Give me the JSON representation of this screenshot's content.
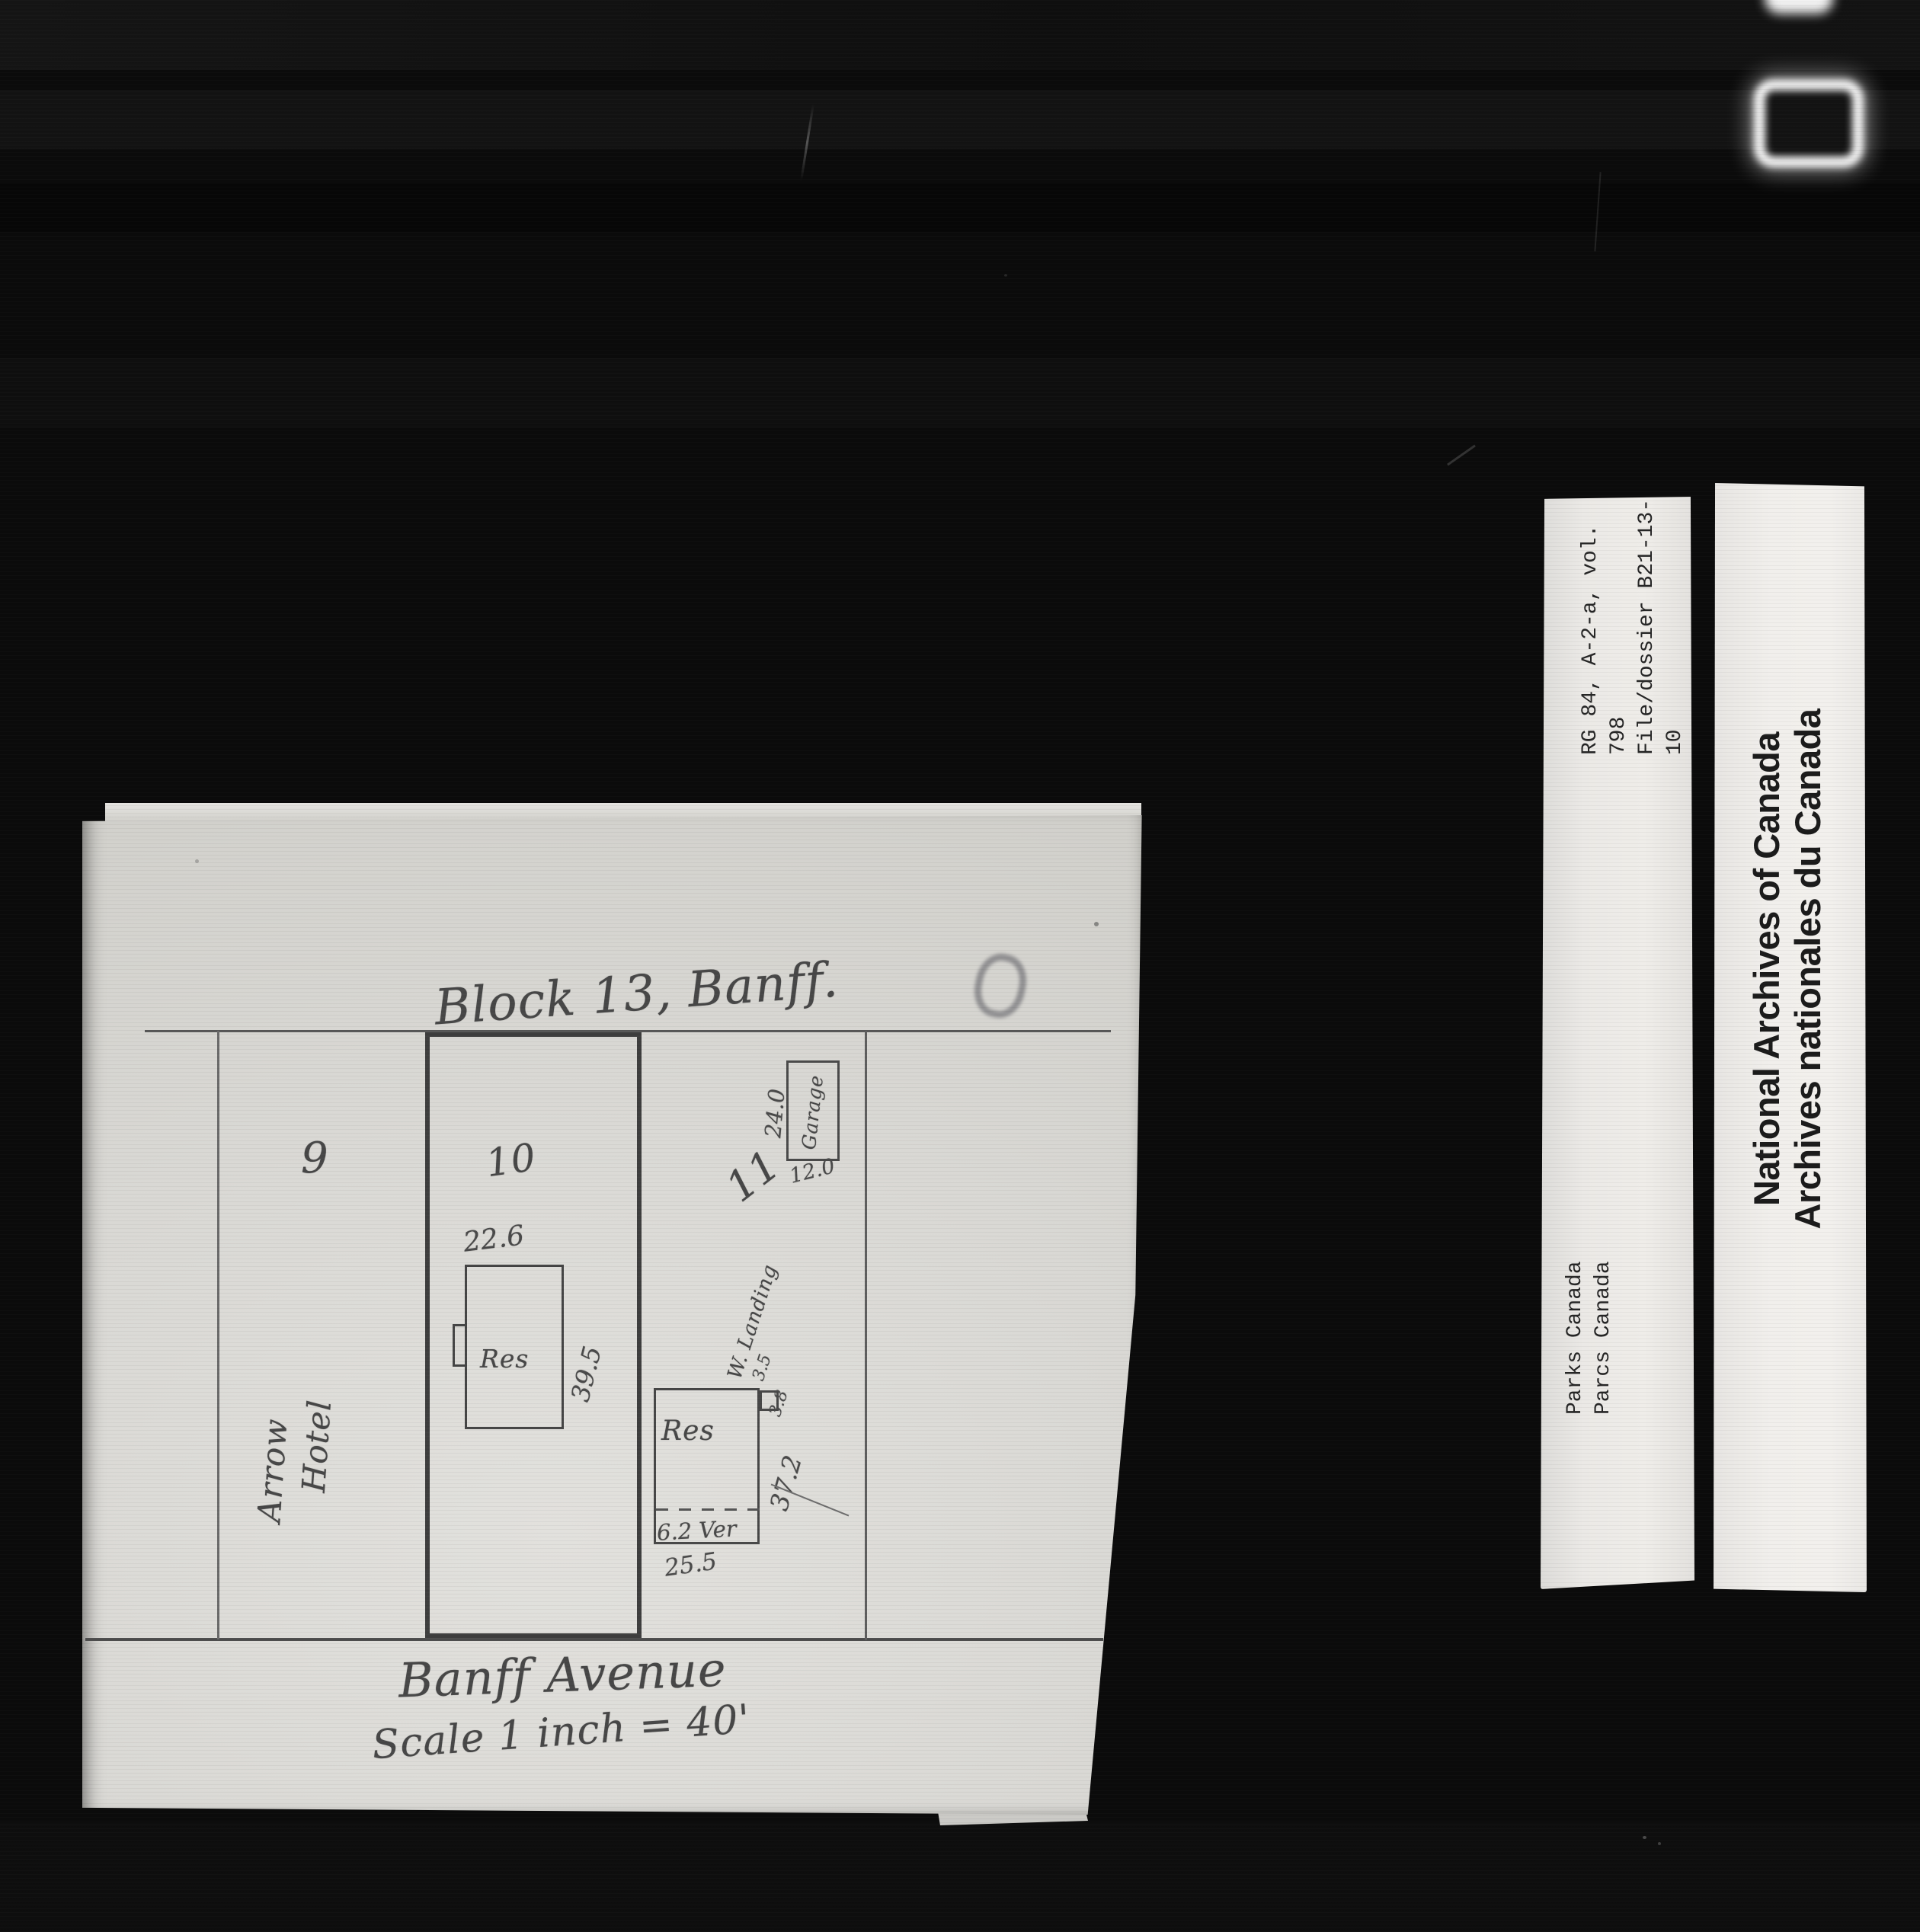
{
  "plan": {
    "title": "Block 13, Banff.",
    "street_label": "Banff Avenue",
    "scale_label": "Scale 1 inch = 40'",
    "lot_numbers": [
      "9",
      "10",
      "11"
    ],
    "hotel_name_line1": "Arrow",
    "hotel_name_line2": "Hotel",
    "res10_label": "Res",
    "res10_width": "22.6",
    "res10_depth": "39.5",
    "garage_label": "Garage",
    "garage_side": "24.0",
    "garage_front": "12.0",
    "res11_label": "Res",
    "res11_depth": "37.2",
    "res11_front": "25.5",
    "res11_veranda": "6.2 Ver",
    "landing_label": "W. Landing",
    "landing_dim1": "3.5",
    "landing_dim2": "3.8"
  },
  "archive_labels": {
    "reference_line1": "RG 84, A-2-a, vol. 798",
    "reference_line2": "File/dossier B21-13-10",
    "reference_line3": "pt 2",
    "agency_line1": "Parks Canada",
    "agency_line2": "Parcs Canada",
    "archives_line1": "National Archives of Canada",
    "archives_line2": "Archives nationales du Canada"
  },
  "colors": {
    "film_background": "#0b0b0b",
    "paper": "#d9d8d4",
    "label_strip": "#efede9",
    "pencil_ink": "#474747"
  }
}
